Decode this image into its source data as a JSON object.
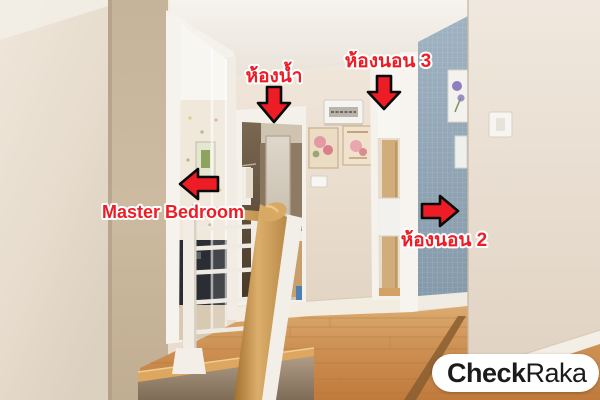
{
  "scene": {
    "type": "annotated real-estate photo",
    "subject": "second-floor hallway and staircase landing inside a house",
    "elements": [
      "wood laminate floor",
      "stair railing with wood handrail and white posts",
      "bathroom doorway with mirror, towels and vanity",
      "master bedroom doorway with glass door",
      "bedroom 3 doorway",
      "blue wallpaper accent wall toward bedroom 2",
      "electrical breaker panel on wall",
      "two floral wall plaques",
      "light switches"
    ]
  },
  "annotations": {
    "bathroom": {
      "label": "ห้องน้ำ",
      "arrow_direction": "down"
    },
    "bedroom3": {
      "label": "ห้องนอน 3",
      "arrow_direction": "down"
    },
    "master_bedroom": {
      "label": "Master Bedroom",
      "arrow_direction": "left"
    },
    "bedroom2": {
      "label": "ห้องนอน 2",
      "arrow_direction": "right"
    }
  },
  "watermark": {
    "name": "CheckRaka",
    "text_bold": "Check",
    "text_regular": "Raka"
  },
  "colors": {
    "annotation_red": "#ee1c24",
    "arrow_outline": "#0a0a0a",
    "label_outline": "#ffffff",
    "watermark_bg": "#ffffff",
    "watermark_text": "#1b1b1b",
    "blue_wallpaper": "#93a7b8",
    "wood_floor": "#cd9053"
  }
}
